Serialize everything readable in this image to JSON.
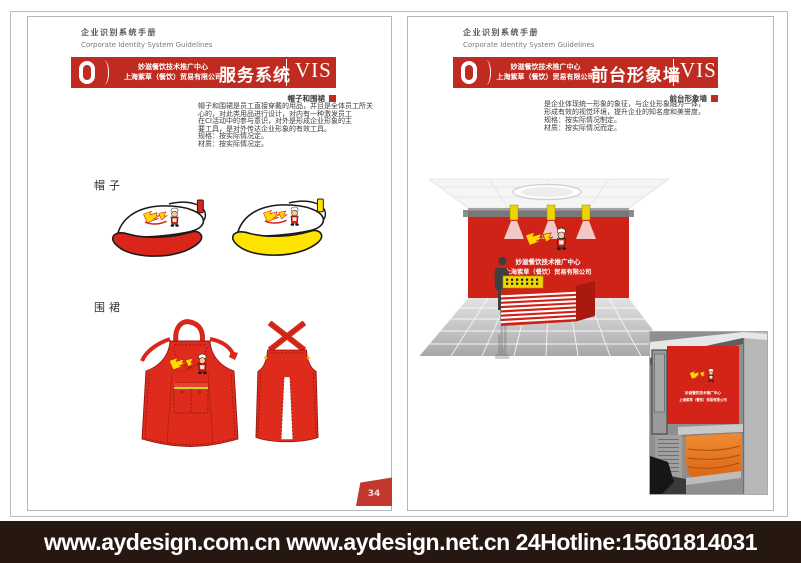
{
  "shared": {
    "manual_title_zh": "企业识别系统手册",
    "manual_title_en": "Corporate Identity System Guidelines",
    "company_line1": "妙滋餐饮技术推广中心",
    "company_line2": "上海紫草（餐饮）贸易有限公司",
    "company_block": "妙滋餐饮技术推广中心\n上海紫草（餐饮）贸易有限公司",
    "vis": "VIS"
  },
  "left_page": {
    "section_title": "服务系统",
    "sub_label": "帽子和围裙",
    "body_lines": [
      "帽子和围裙是员工直接穿戴的用品，并且是全体员工所关",
      "心的，对此类用品进行设计，对内有一种激发员工",
      "在CI活动中的参与意识，对外是形成企业形象的主",
      "要工具，是对外传达企业形象的有效工具。",
      "规格：按实际情况定。",
      "材质：按实际情况定。"
    ],
    "hat_label": "帽子",
    "apron_label": "围裙",
    "page_number": "34"
  },
  "right_page": {
    "section_title": "前台形象墙",
    "sub_label": "前台形象墙",
    "body_lines": [
      "是企业体现统一形象的象征，与企业形象融为一体，",
      "形成有效的视觉环境，提升企业的知名度和美誉度。",
      "规格：按实际情况制定。",
      "材质：按实际情况而定。"
    ],
    "wall_line1": "妙滋餐饮技术推广中心",
    "wall_line2": "上海紫草（餐饮）贸易有限公司",
    "photo_line1": "妙滋餐饮技术推广中心",
    "photo_line2": "上海紫草（餐饮）贸易有限公司"
  },
  "footer": {
    "text": "www.aydesign.com.cn www.aydesign.net.cn 24Hotline:15601814031"
  },
  "colors": {
    "brand_red": "#bf2b20",
    "bright_red": "#cf2318",
    "accent_yellow": "#ffd800",
    "footer_bg": "#261711",
    "desk_orange": "#e5761e"
  }
}
